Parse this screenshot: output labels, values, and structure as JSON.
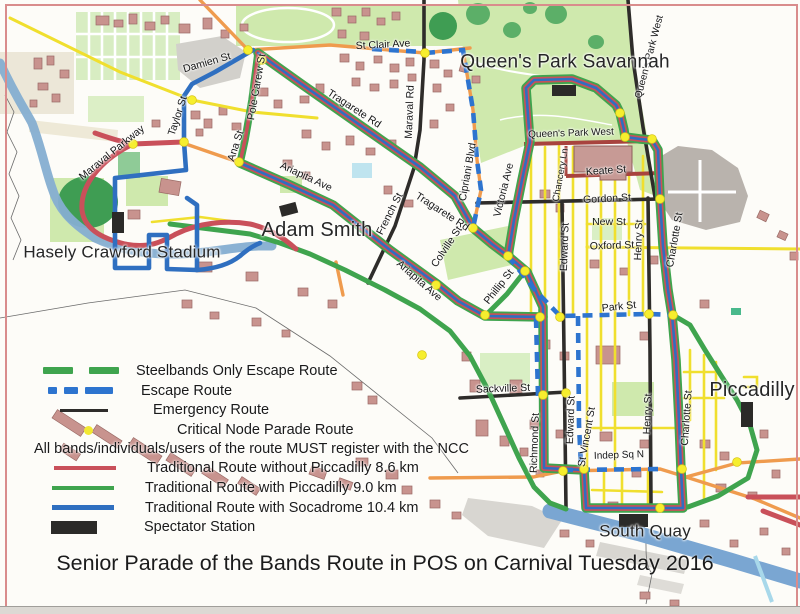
{
  "title": "Senior Parade of the Bands Route in POS on Carnival Tuesday 2016",
  "legend": {
    "note": "All bands/individuals/users of the route MUST register with the NCC",
    "items": [
      {
        "label": "Steelbands Only Escape Route",
        "swatch": "dash-green"
      },
      {
        "label": "Escape Route",
        "swatch": "dash-blue"
      },
      {
        "label": "Emergency Route",
        "swatch": "line-black"
      },
      {
        "label": "Critical Node Parade Route",
        "swatch": "dot-yellow"
      },
      {
        "label": "Traditional Route without Piccadilly 8.6 km",
        "swatch": "line-red"
      },
      {
        "label": "Traditional Route with Piccadilly 9.0 km",
        "swatch": "line-green"
      },
      {
        "label": "Traditional Route with Socadrome 10.4 km",
        "swatch": "line-blue"
      },
      {
        "label": "Spectator Station",
        "swatch": "rect-black"
      }
    ]
  },
  "places": [
    {
      "text": "Queen's Park Savannah",
      "x": 565,
      "y": 62,
      "fs": 19
    },
    {
      "text": "Adam Smith",
      "x": 317,
      "y": 230,
      "fs": 20
    },
    {
      "text": "Hasely Crawford Stadium",
      "x": 122,
      "y": 252,
      "fs": 17
    },
    {
      "text": "Piccadilly",
      "x": 752,
      "y": 390,
      "fs": 20
    },
    {
      "text": "South Quay",
      "x": 645,
      "y": 531,
      "fs": 17
    }
  ],
  "streets": [
    {
      "text": "St Clair Ave",
      "x": 383,
      "y": 45,
      "rot": -3
    },
    {
      "text": "Damien St",
      "x": 207,
      "y": 63,
      "rot": -16
    },
    {
      "text": "Maraval Parkway",
      "x": 112,
      "y": 153,
      "rot": -39
    },
    {
      "text": "Taylor St",
      "x": 178,
      "y": 116,
      "rot": -72
    },
    {
      "text": "Pole Carew St",
      "x": 257,
      "y": 87,
      "rot": -80
    },
    {
      "text": "Ana St",
      "x": 236,
      "y": 146,
      "rot": -72
    },
    {
      "text": "Tragarete Rd",
      "x": 354,
      "y": 109,
      "rot": 33
    },
    {
      "text": "Tragarete Rd",
      "x": 442,
      "y": 212,
      "rot": 33
    },
    {
      "text": "Maraval Rd",
      "x": 410,
      "y": 112,
      "rot": -88
    },
    {
      "text": "Cipriani Blvd",
      "x": 468,
      "y": 172,
      "rot": -80
    },
    {
      "text": "Victoria Ave",
      "x": 504,
      "y": 190,
      "rot": -76
    },
    {
      "text": "French St",
      "x": 390,
      "y": 214,
      "rot": -63
    },
    {
      "text": "Ariapita Ave",
      "x": 306,
      "y": 177,
      "rot": 25
    },
    {
      "text": "Ariapita Ave",
      "x": 419,
      "y": 281,
      "rot": 41
    },
    {
      "text": "Colville St",
      "x": 447,
      "y": 247,
      "rot": -56
    },
    {
      "text": "Phillip St",
      "x": 499,
      "y": 287,
      "rot": -52
    },
    {
      "text": "Queen's Park West",
      "x": 571,
      "y": 134,
      "rot": -2,
      "fs": 10
    },
    {
      "text": "Queen's Park West",
      "x": 650,
      "y": 57,
      "rot": -75,
      "fs": 10
    },
    {
      "text": "Chancery Ln",
      "x": 561,
      "y": 175,
      "rot": -80,
      "fs": 9.5
    },
    {
      "text": "Keate St",
      "x": 606,
      "y": 171,
      "rot": -4
    },
    {
      "text": "Gordon St",
      "x": 607,
      "y": 199,
      "rot": -3
    },
    {
      "text": "New St",
      "x": 609,
      "y": 222,
      "rot": 0
    },
    {
      "text": "Oxford St",
      "x": 612,
      "y": 246,
      "rot": -2
    },
    {
      "text": "Edward St",
      "x": 565,
      "y": 247,
      "rot": -88
    },
    {
      "text": "Edward St",
      "x": 571,
      "y": 420,
      "rot": -88
    },
    {
      "text": "Henry St",
      "x": 639,
      "y": 240,
      "rot": -88
    },
    {
      "text": "Henry St",
      "x": 648,
      "y": 414,
      "rot": -88
    },
    {
      "text": "Charlotte St",
      "x": 675,
      "y": 240,
      "rot": -80
    },
    {
      "text": "Charlotte St",
      "x": 687,
      "y": 418,
      "rot": -86
    },
    {
      "text": "Park St",
      "x": 619,
      "y": 307,
      "rot": -6
    },
    {
      "text": "Sackville St",
      "x": 503,
      "y": 389,
      "rot": -2
    },
    {
      "text": "Richmond St",
      "x": 535,
      "y": 443,
      "rot": -88
    },
    {
      "text": "St Vincent St",
      "x": 587,
      "y": 437,
      "rot": -80
    },
    {
      "text": "Indep Sq N",
      "x": 619,
      "y": 456,
      "rot": -2,
      "fs": 10
    }
  ],
  "colors": {
    "routeRed": "#c9505a",
    "routeGreen": "#3fa44e",
    "routeBlue": "#2f6fc0",
    "escapeBlue": "#2d74cf",
    "emergencyBlack": "#2e2c2a",
    "nodeYellow": "#f6ee2e",
    "roadYellow": "#f0df2e",
    "roadOrange": "#ef9b4e",
    "roadMaroon": "#a8433e",
    "river": "#85aed1",
    "parkGreen": "#cfe9ad",
    "building": "#c8938e",
    "spectatorBlack": "#2b2a28"
  }
}
